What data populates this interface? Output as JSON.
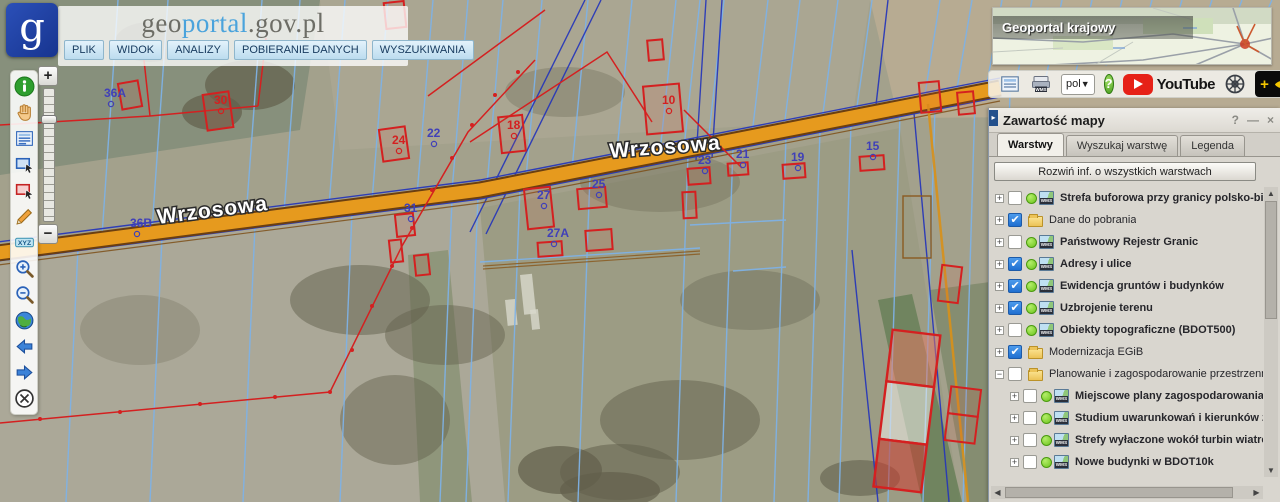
{
  "header": {
    "logo_letter": "g",
    "brand": {
      "part1": "geo",
      "part2": "portal",
      "part3": ".gov.pl"
    },
    "menu": [
      "PLIK",
      "WIDOK",
      "ANALIZY",
      "POBIERANIE DANYCH",
      "WYSZUKIWANIA"
    ]
  },
  "left_toolbar": {
    "icons": [
      "info-icon",
      "pan-hand-icon",
      "attribute-table-icon",
      "select-area-blue-icon",
      "select-area-red-icon",
      "draw-pencil-icon",
      "xyz-label-icon",
      "zoom-in-icon",
      "zoom-out-icon",
      "full-extent-globe-icon",
      "previous-view-icon",
      "next-view-icon",
      "clear-map-icon"
    ]
  },
  "zoom_slider": {
    "plus": "+",
    "minus": "−"
  },
  "minimap": {
    "title": "Geoportal krajowy"
  },
  "utility_bar": {
    "language_value": "pol",
    "help_label": "?",
    "youtube_label": "YouTube",
    "contrast_plus": "+"
  },
  "panel": {
    "title": "Zawartość mapy",
    "controls": {
      "help": "?",
      "minimize": "—",
      "close": "×"
    },
    "tabs": [
      {
        "label": "Warstwy",
        "active": true
      },
      {
        "label": "Wyszukaj warstwę",
        "active": false
      },
      {
        "label": "Legenda",
        "active": false
      }
    ],
    "expand_button": "Rozwiń inf. o wszystkich warstwach",
    "layers": [
      {
        "label": "Strefa buforowa przy granicy polsko-biało",
        "type": "wms",
        "checked": false,
        "expander": "+",
        "indent": 0
      },
      {
        "label": "Dane do pobrania",
        "type": "folder",
        "checked": true,
        "expander": "+",
        "indent": 0
      },
      {
        "label": "Państwowy Rejestr Granic",
        "type": "wms",
        "checked": false,
        "expander": "+",
        "indent": 0
      },
      {
        "label": "Adresy i ulice",
        "type": "wms",
        "checked": true,
        "expander": "+",
        "indent": 0
      },
      {
        "label": "Ewidencja gruntów i budynków",
        "type": "wms",
        "checked": true,
        "expander": "+",
        "indent": 0
      },
      {
        "label": "Uzbrojenie terenu",
        "type": "wms",
        "checked": true,
        "expander": "+",
        "indent": 0
      },
      {
        "label": "Obiekty topograficzne (BDOT500)",
        "type": "wms",
        "checked": false,
        "expander": "+",
        "indent": 0
      },
      {
        "label": "Modernizacja EGiB",
        "type": "folder",
        "checked": true,
        "expander": "+",
        "indent": 0
      },
      {
        "label": "Planowanie i zagospodarowanie przestrzenne",
        "type": "folder",
        "checked": false,
        "expander": "−",
        "indent": 0
      },
      {
        "label": "Miejscowe plany zagospodarowania prz",
        "type": "wms",
        "checked": false,
        "expander": "+",
        "indent": 1
      },
      {
        "label": "Studium uwarunkowań i kierunków zag",
        "type": "wms",
        "checked": false,
        "expander": "+",
        "indent": 1
      },
      {
        "label": "Strefy wyłaczone wokół turbin wiatrow",
        "type": "wms",
        "checked": false,
        "expander": "+",
        "indent": 1
      },
      {
        "label": "Nowe budynki w BDOT10k",
        "type": "wms",
        "checked": false,
        "expander": "+",
        "indent": 1
      },
      {
        "label": "Portale mapowe",
        "type": "folder",
        "checked": true,
        "expander": "+",
        "indent": 0
      },
      {
        "label": "Specjalistyczne informacje geodezyjne",
        "type": "folder",
        "checked": true,
        "expander": "+",
        "indent": 0
      }
    ]
  },
  "map": {
    "street_labels": [
      {
        "text": "Wrzosowa",
        "x": 158,
        "y": 224,
        "rotate": -7.3,
        "size": 21
      },
      {
        "text": "Wrzosowa",
        "x": 610,
        "y": 158,
        "rotate": -4.5,
        "size": 21
      }
    ],
    "parcel_labels": [
      {
        "text": "36A",
        "x": 104,
        "y": 97,
        "color": "#4040b8"
      },
      {
        "text": "36B",
        "x": 130,
        "y": 227,
        "color": "#4040b8"
      },
      {
        "text": "30",
        "x": 214,
        "y": 104,
        "color": "#d42020"
      },
      {
        "text": "24",
        "x": 392,
        "y": 144,
        "color": "#d42020"
      },
      {
        "text": "22",
        "x": 427,
        "y": 137,
        "color": "#4040b8"
      },
      {
        "text": "18",
        "x": 507,
        "y": 129,
        "color": "#d42020"
      },
      {
        "text": "10",
        "x": 662,
        "y": 104,
        "color": "#d42020"
      },
      {
        "text": "27",
        "x": 537,
        "y": 199,
        "color": "#4040b8"
      },
      {
        "text": "25",
        "x": 592,
        "y": 188,
        "color": "#4040b8"
      },
      {
        "text": "27A",
        "x": 547,
        "y": 237,
        "color": "#4040b8"
      },
      {
        "text": "23",
        "x": 698,
        "y": 164,
        "color": "#4040b8"
      },
      {
        "text": "21",
        "x": 736,
        "y": 158,
        "color": "#4040b8"
      },
      {
        "text": "19",
        "x": 791,
        "y": 161,
        "color": "#4040b8"
      },
      {
        "text": "15",
        "x": 866,
        "y": 150,
        "color": "#4040b8"
      },
      {
        "text": "31",
        "x": 404,
        "y": 212,
        "color": "#4040b8"
      }
    ],
    "colors": {
      "road": "#e69a1e",
      "road_edge": "#6b3f10",
      "parcel_line": "#7fb2e5",
      "cadastre_navy": "#2233bb",
      "building_red": "#d42020",
      "field_base": "#a3a18c"
    }
  }
}
